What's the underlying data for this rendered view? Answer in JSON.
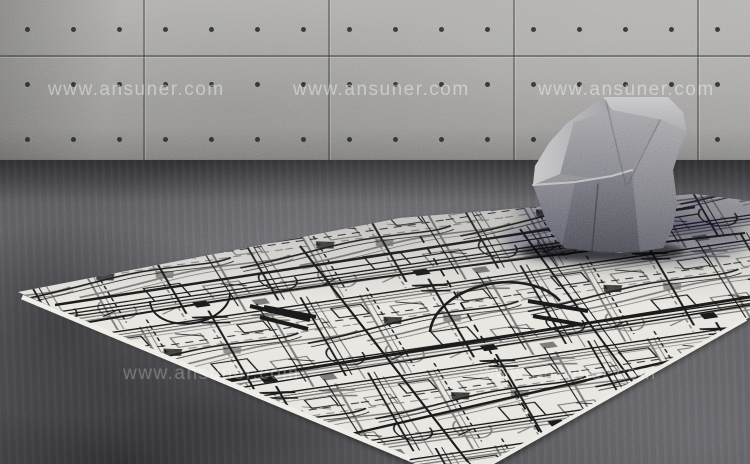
{
  "watermark": {
    "text": "www.ansuner.com",
    "font_size": 19,
    "letter_spacing": 1.5,
    "color": "#ffffff",
    "rows": [
      {
        "y": 79,
        "opacity": 0.42,
        "xs": [
          48,
          293,
          538
        ]
      },
      {
        "y": 363,
        "opacity": 0.26,
        "xs": [
          123,
          480
        ]
      }
    ]
  },
  "wall": {
    "panel_joints_x": [
      143,
      328,
      513,
      697
    ],
    "horizontal_joint_y": 55,
    "dot_rows_y": [
      27,
      82,
      137
    ],
    "dot_start_x": 25,
    "dot_spacing": 46,
    "dot_count": 16,
    "floor_line_y": 162
  },
  "rug": {
    "base_color": "#e8e6e0",
    "ink_color": "#191919",
    "outline": [
      [
        18,
        292
      ],
      [
        400,
        218
      ],
      [
        695,
        194
      ],
      [
        750,
        201
      ],
      [
        750,
        317
      ],
      [
        494,
        464
      ],
      [
        415,
        464
      ]
    ],
    "edges": [
      {
        "d": "M22,297 L410,459",
        "w": 5,
        "stroke": "#efede7"
      },
      {
        "d": "M497,460 L746,319",
        "w": 4,
        "stroke": "#eceae4"
      }
    ],
    "features": [
      {
        "d": "M55,305 L695,207",
        "w": 2.5
      },
      {
        "d": "M58,312 L698,214",
        "w": 1.2
      },
      {
        "d": "M35,332 Q300,282 745,233",
        "w": 2
      },
      {
        "d": "M160,392 L750,297",
        "w": 3
      },
      {
        "d": "M165,400 L750,305",
        "w": 1.4
      },
      {
        "d": "M255,456 L740,345",
        "w": 2.4
      },
      {
        "d": "M300,246 L468,462",
        "w": 2.2
      },
      {
        "d": "M520,229 L662,422",
        "w": 2
      },
      {
        "d": "M527,226 L669,419",
        "w": 1
      },
      {
        "d": "M420,236 L558,463",
        "w": 1.8,
        "dash": "8 5"
      },
      {
        "d": "M430,332 A70 46 -9 0 1 560,301",
        "w": 2.6
      },
      {
        "d": "M150,301 A40 26 -9 0 0 230,293",
        "w": 2
      },
      {
        "d": "M250,306 l60,14 m-50,-3 l48,12 m-44,-22 l52,10",
        "w": 4
      },
      {
        "d": "M528,301 l60,10 m-55,5 l50,9",
        "w": 4
      }
    ]
  },
  "chair": {
    "fabric": "gray speckled upholstery",
    "silhouette": "603,97 668,97 683,112 687,132 680,148 673,170 677,203 673,227 663,248 620,253 565,248 549,228 542,210 533,185 535,166 549,143 566,124 585,110",
    "facets": [
      {
        "name": "top-band",
        "points": "603,97 668,97 683,112 687,132 662,120 612,110",
        "fill": "url(#g-band)"
      },
      {
        "name": "right-side",
        "points": "687,132 680,148 673,170 677,203 673,227 663,248 640,252 632,170 662,120",
        "fill": "url(#g-right)"
      },
      {
        "name": "inner-bowl",
        "points": "612,110 662,120 632,170 626,182 560,174 574,122",
        "fill": "url(#g-bowl)"
      },
      {
        "name": "left-wing",
        "points": "603,97 612,110 574,122 560,174 533,185 535,166 549,143 566,124 585,110",
        "fill": "url(#g-wing)"
      },
      {
        "name": "base-front",
        "points": "533,185 612,176 632,170 640,252 600,253 565,248 549,228 542,210",
        "fill": "url(#g-base)"
      },
      {
        "name": "base-left",
        "points": "533,185 575,182 562,246 549,228 542,210",
        "fill": "url(#g-baseL)"
      }
    ],
    "lines": [
      {
        "d": "M533,185 L575,182 L612,176 L632,170",
        "stroke": "#cdcdd1",
        "w": 2,
        "opacity": 0.85
      },
      {
        "d": "M606,101 L626,186",
        "stroke": "rgba(70,70,78,.4)",
        "w": 1.4,
        "opacity": 1
      },
      {
        "d": "M660,120 L628,184",
        "stroke": "rgba(70,70,78,.4)",
        "w": 1.4,
        "opacity": 1
      },
      {
        "d": "M598,184 L592,251",
        "stroke": "rgba(25,25,33,.45)",
        "w": 1.6,
        "opacity": 1
      }
    ],
    "shadows": [
      {
        "cx": 648,
        "cy": 212,
        "rx": 135,
        "ry": 22,
        "fill": "rgba(16,16,20,0.28)",
        "filter": "url(#blur8)"
      },
      {
        "cx": 625,
        "cy": 240,
        "rx": 125,
        "ry": 26,
        "fill": "rgba(12,12,16,0.35)",
        "filter": "url(#blur8)"
      },
      {
        "cx": 602,
        "cy": 251,
        "rx": 82,
        "ry": 11,
        "fill": "rgba(6,6,8,0.6)",
        "filter": "url(#blur4)"
      }
    ]
  }
}
